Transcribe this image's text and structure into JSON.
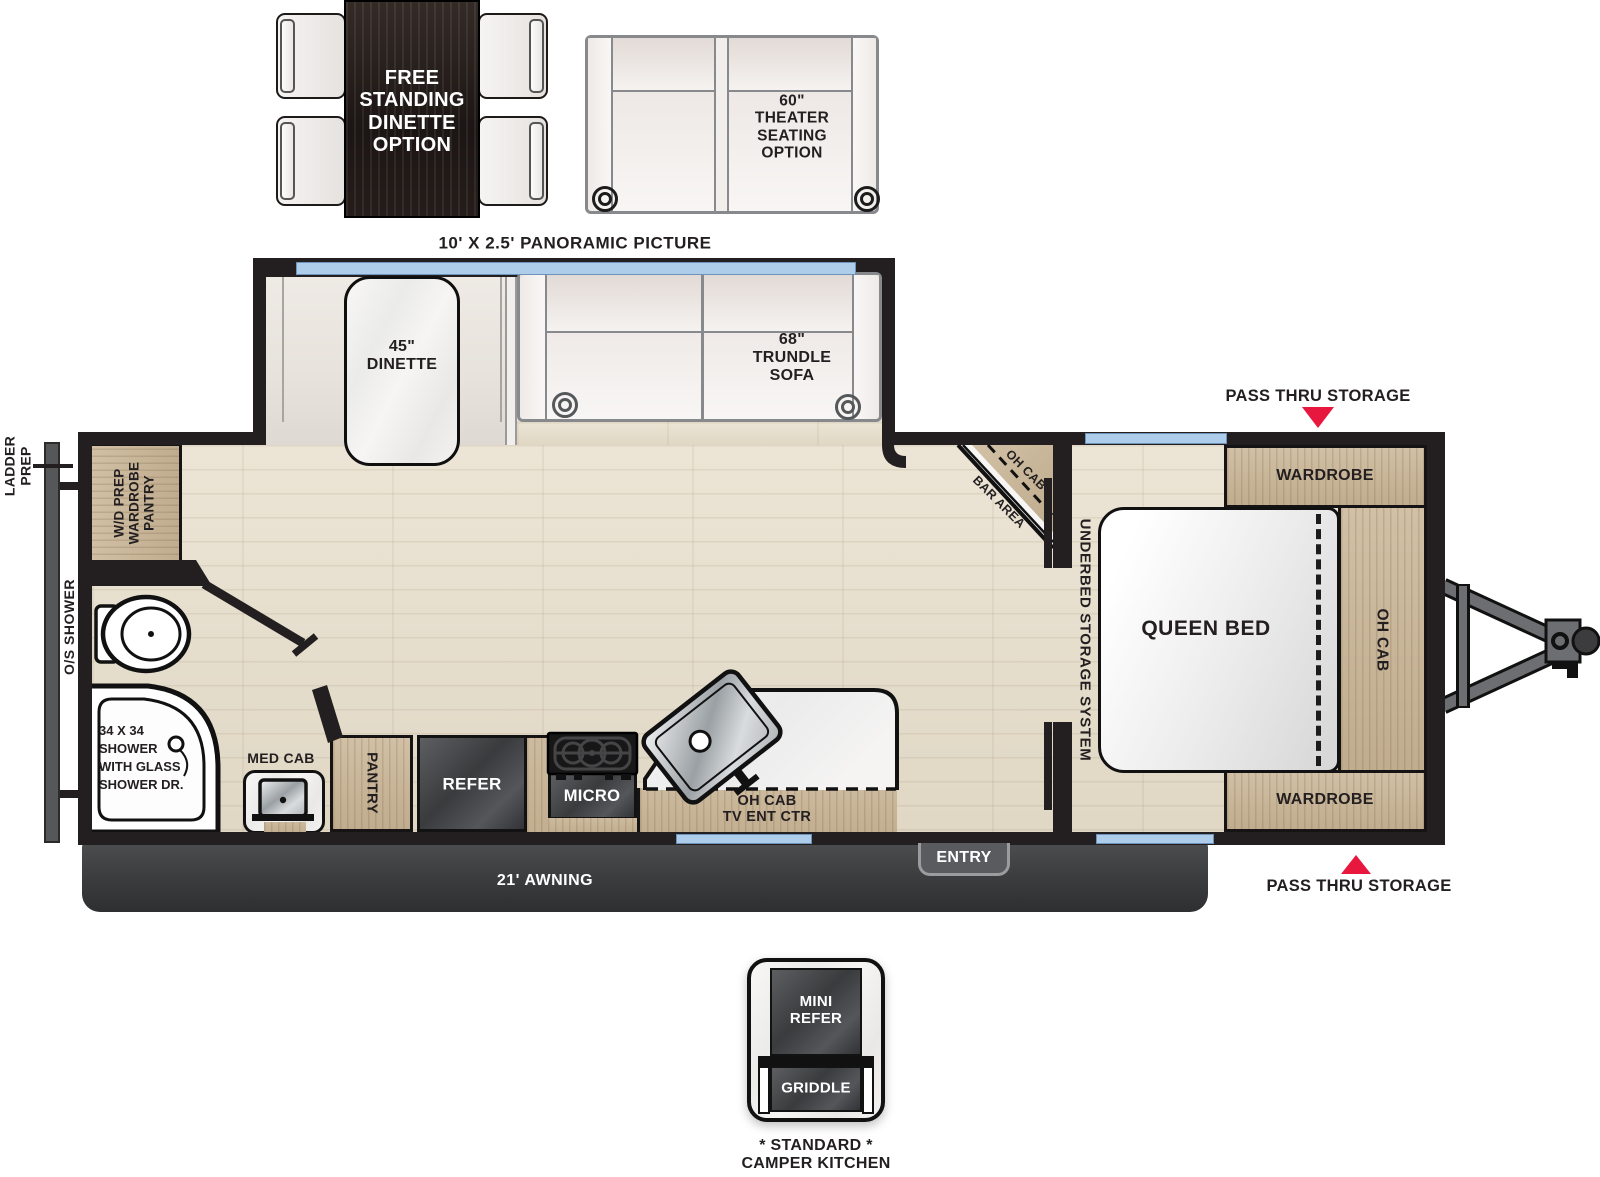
{
  "options": {
    "dinette_label": "FREE\nSTANDING\nDINETTE\nOPTION",
    "theater_label": "60\"\nTHEATER\nSEATING\nOPTION",
    "panoramic_label": "10' X 2.5' PANORAMIC PICTURE"
  },
  "slideout": {
    "dinette": "45\"\nDINETTE",
    "trundle_sofa": "68\"\nTRUNDLE\nSOFA"
  },
  "bedroom": {
    "pass_thru_storage_top": "PASS THRU STORAGE",
    "pass_thru_storage_bottom": "PASS THRU STORAGE",
    "wardrobe_front": "WARDROBE",
    "wardrobe_rear": "WARDROBE",
    "queen_bed": "QUEEN BED",
    "oh_cab": "OH CAB",
    "underbed_storage": "UNDERBED STORAGE SYSTEM"
  },
  "living": {
    "bar_oh_cab": "OH CAB",
    "bar_area": "BAR AREA"
  },
  "kitchen": {
    "tv_center": "OH CAB\nTV ENT CTR",
    "micro": "MICRO",
    "refer": "REFER",
    "pantry": "PANTRY"
  },
  "bath": {
    "med_cab": "MED CAB",
    "shower": "34 X 34\nSHOWER\nWITH GLASS\nSHOWER DR.",
    "outside_shower": "O/S SHOWER",
    "wd_prep": "W/D PREP\nWARDROBE\nPANTRY",
    "ladder_prep": "LADDER\nPREP"
  },
  "exterior": {
    "awning": "21' AWNING",
    "entry": "ENTRY",
    "camper_kitchen": {
      "mini_refer": "MINI\nREFER",
      "griddle": "GRIDDLE",
      "note": "* STANDARD *\nCAMPER KITCHEN"
    }
  },
  "colors": {
    "wall": "#231f20",
    "wood": "#c9b69a",
    "appliance_dark": "#3f4042",
    "window_blue": "#aecdea",
    "arrow_red": "#e8173d",
    "floor": "#e8e0d0",
    "marble": "#f4f3f1"
  }
}
